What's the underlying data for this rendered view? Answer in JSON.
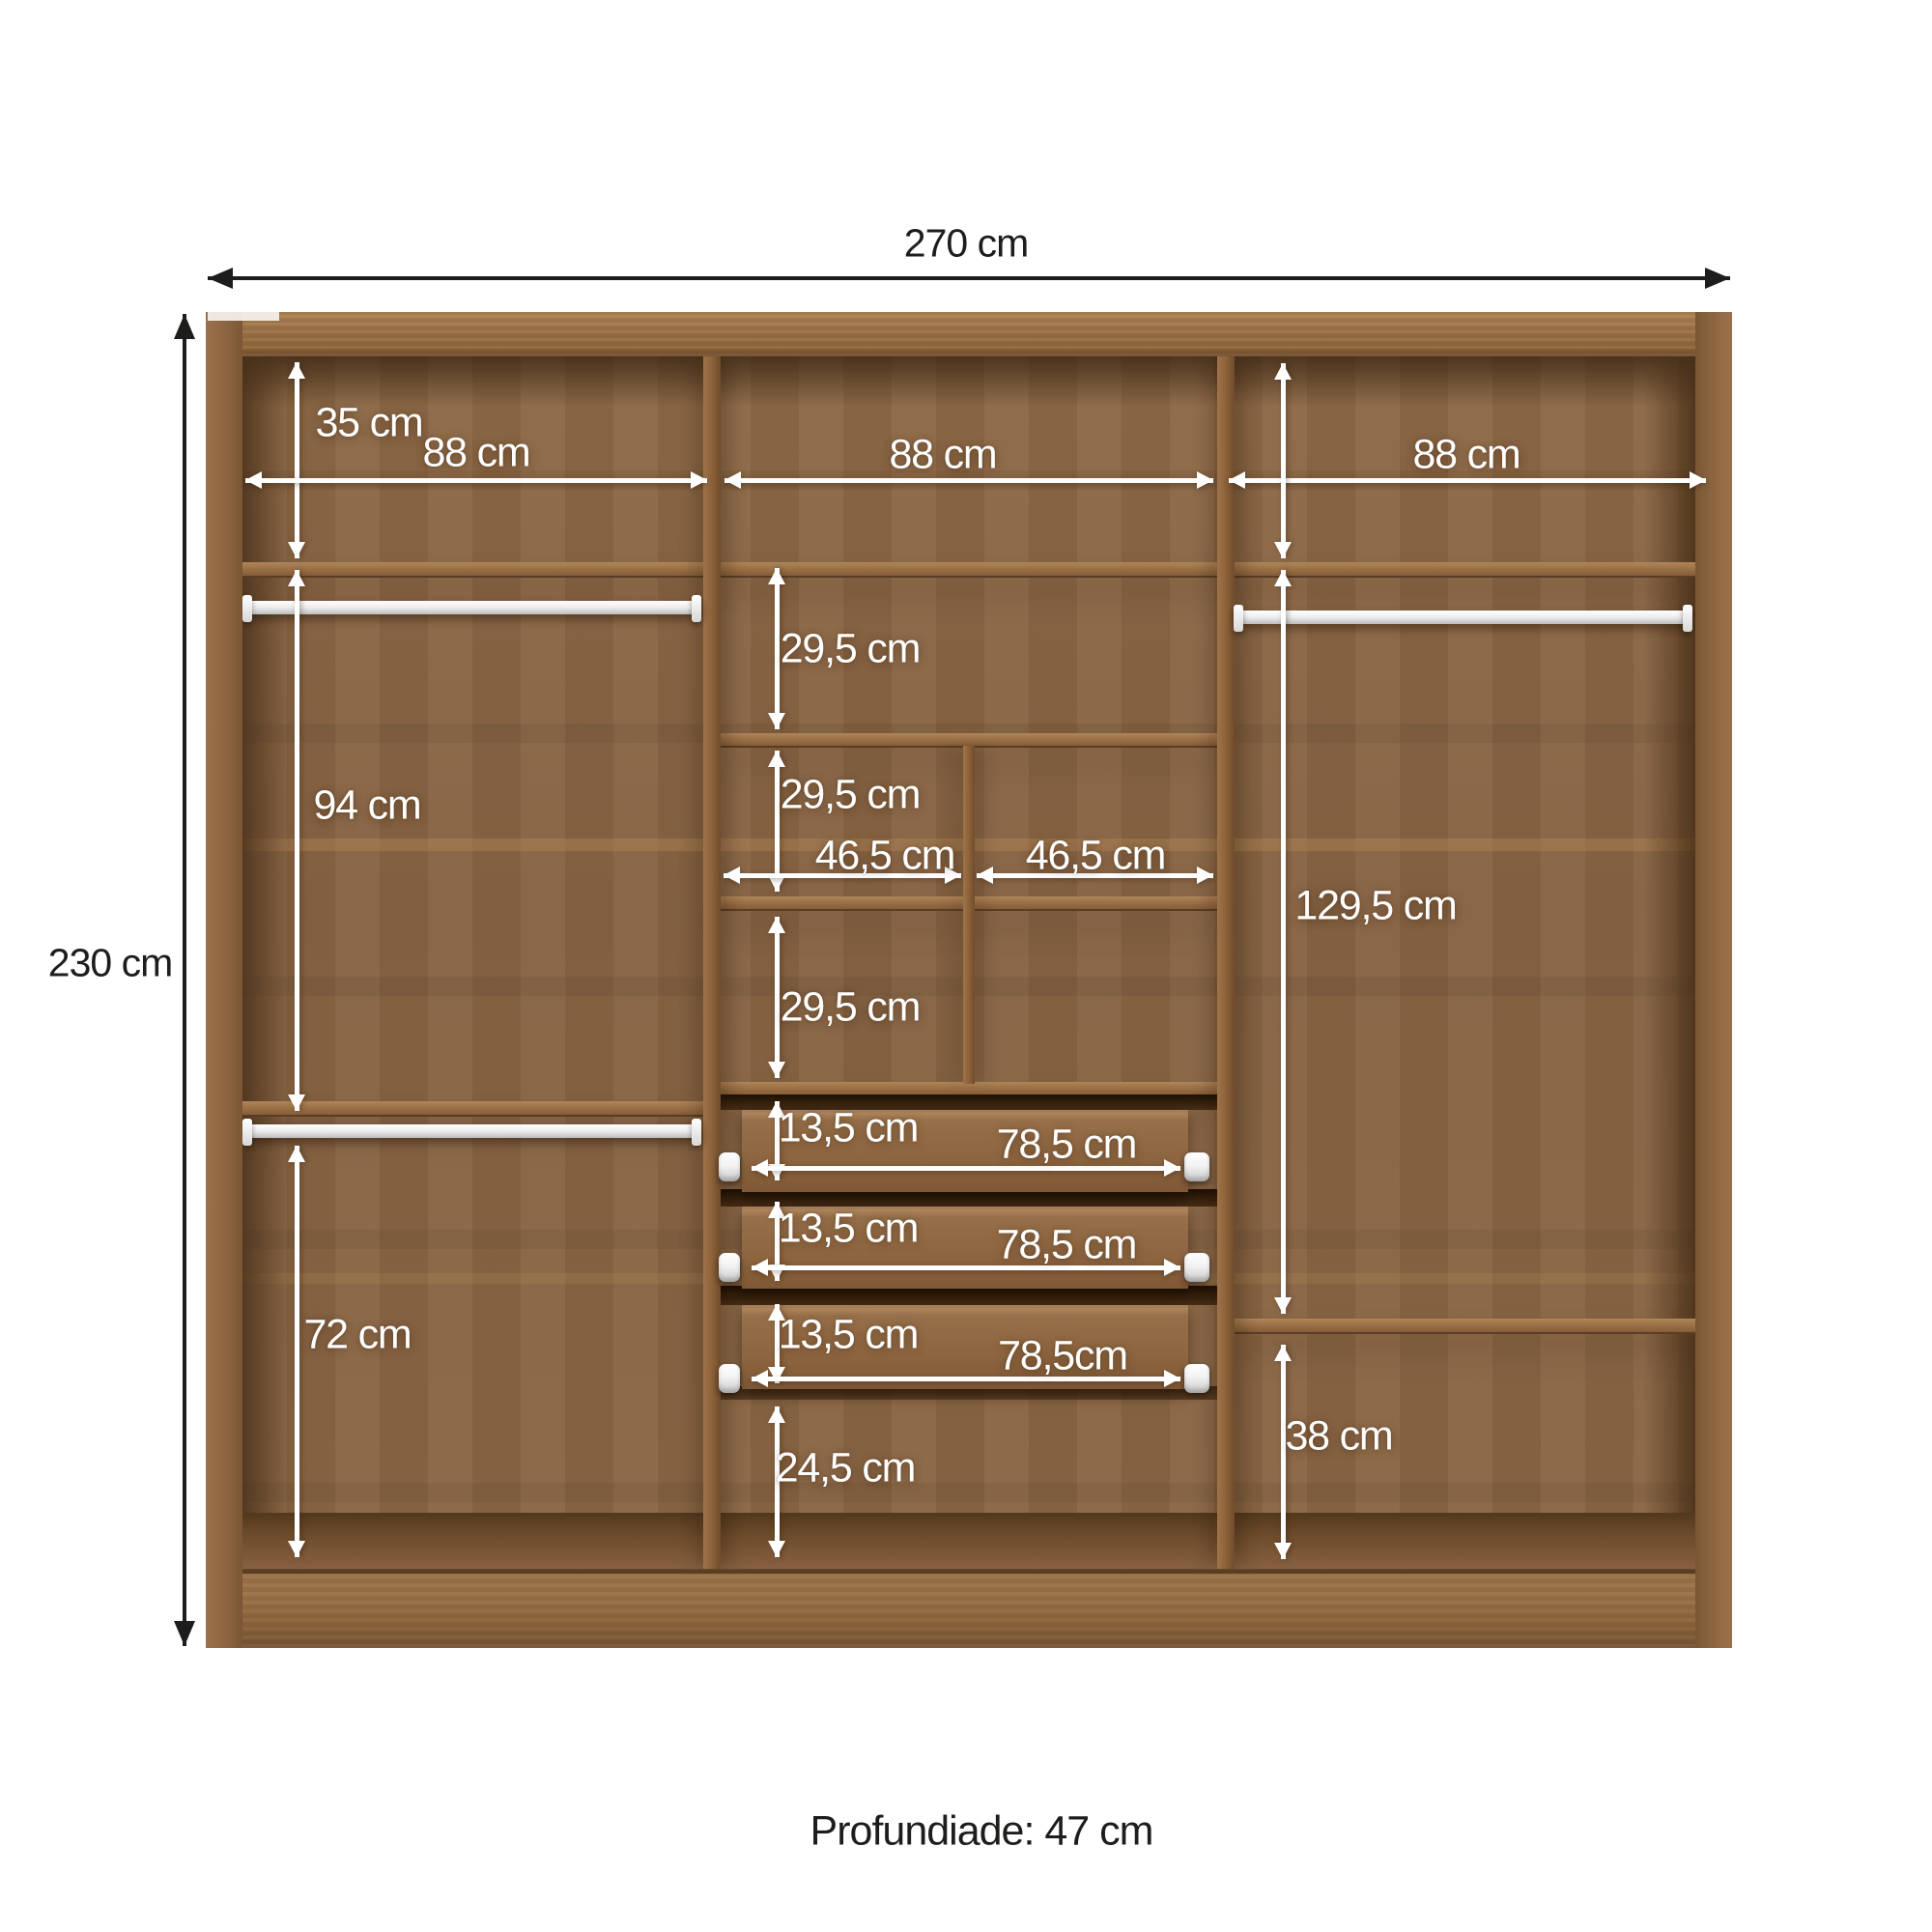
{
  "diagram": {
    "type": "furniture-dimension-diagram",
    "subject": "wardrobe-interior",
    "overall": {
      "width": "270 cm",
      "height": "230 cm"
    },
    "footer_depth": "Profundiade: 47 cm",
    "top_row": {
      "height": "35 cm",
      "col_widths": [
        "88 cm",
        "88 cm",
        "88 cm"
      ]
    },
    "left_column": {
      "upper_height": "94 cm",
      "lower_height": "72 cm"
    },
    "middle_column": {
      "shelf_heights": [
        "29,5 cm",
        "29,5 cm",
        "29,5 cm"
      ],
      "half_widths": [
        "46,5 cm",
        "46,5 cm"
      ],
      "drawer_heights": [
        "13,5 cm",
        "13,5 cm",
        "13,5 cm"
      ],
      "drawer_widths": [
        "78,5 cm",
        "78,5 cm",
        "78,5cm"
      ],
      "bottom_height": "24,5 cm"
    },
    "right_column": {
      "upper_height": "129,5 cm",
      "lower_height": "38 cm"
    },
    "colors": {
      "wood_light": "#a1774a",
      "wood_mid": "#8a6643",
      "wood_dark": "#6b4a2a",
      "interior_shadow": "#3f2a14",
      "rod": "#ffffff",
      "dim_line_white": "#ffffff",
      "dim_line_black": "#1d1d1b",
      "text_dark": "#1d1d1b",
      "background": "#ffffff"
    }
  }
}
